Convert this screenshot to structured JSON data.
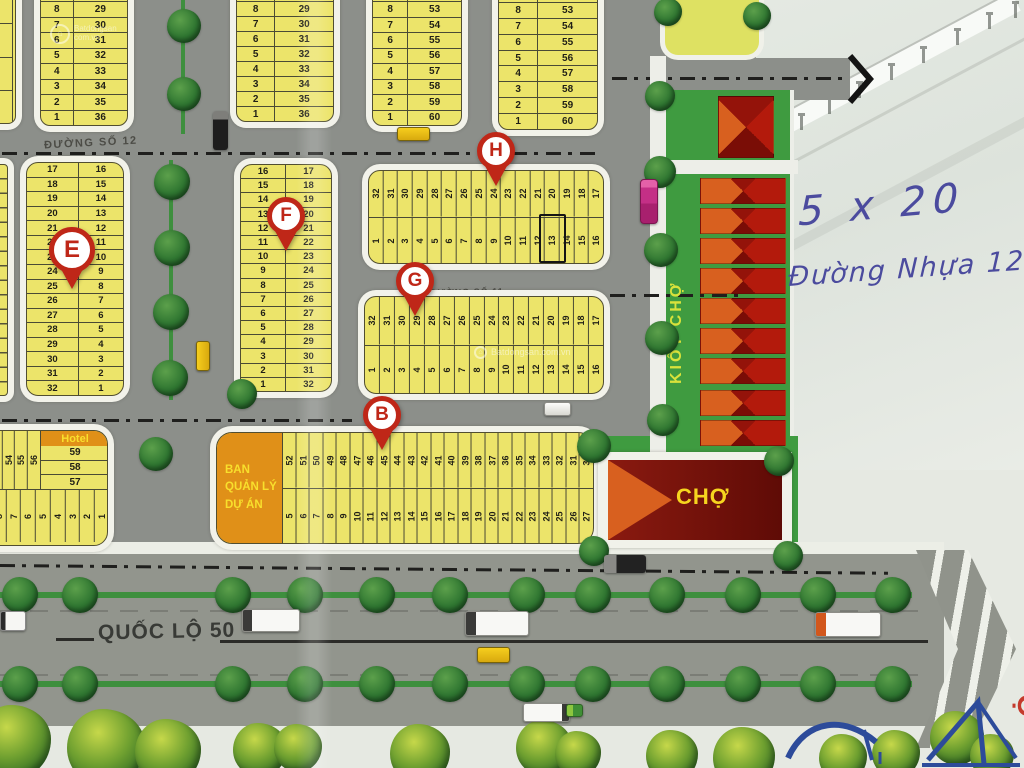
{
  "roads": {
    "street12": "ĐƯỜNG SỐ 12",
    "street11": "ĐƯỜNG SỐ 11",
    "highway": "QUỐC LỘ 50"
  },
  "notes": {
    "size": "5 x 20",
    "road": "Đường Nhựa 12 m."
  },
  "market": {
    "kiosk_label": "KIỐT CHỢ",
    "market_label": "CHỢ"
  },
  "office": {
    "line1": "BAN",
    "line2": "QUẢN LÝ",
    "line3": "DỰ ÁN"
  },
  "hotel": {
    "label": "Hotel",
    "stack": [
      "59",
      "58",
      "57"
    ],
    "top_row": [
      "52",
      "53",
      "54",
      "55",
      "56"
    ],
    "bottom_row": [
      "9",
      "8",
      "7",
      "6",
      "5",
      "4",
      "3",
      "2",
      "1"
    ]
  },
  "pins": {
    "e": "E",
    "f": "F",
    "g": "G",
    "h": "H",
    "b": "B"
  },
  "edge_text": "Ộ",
  "watermark": {
    "site1": "Batdongsan",
    "site2": "com.vn",
    "center": "Batdongsan.com.vn"
  },
  "blocks": {
    "top_partial": [
      "9",
      "8",
      "7",
      "6"
    ],
    "top1": {
      "c1": [
        "9",
        "8",
        "7",
        "6",
        "5",
        "4",
        "3",
        "2",
        "1"
      ],
      "c2": [
        "28",
        "29",
        "30",
        "31",
        "32",
        "33",
        "34",
        "35",
        "36"
      ]
    },
    "top2": {
      "c1": [
        "9",
        "8",
        "7",
        "6",
        "5",
        "4",
        "3",
        "2",
        "1"
      ],
      "c2": [
        "28",
        "29",
        "30",
        "31",
        "32",
        "33",
        "34",
        "35",
        "36"
      ]
    },
    "top3": {
      "c1": [
        "9",
        "8",
        "7",
        "6",
        "5",
        "4",
        "3",
        "2",
        "1"
      ],
      "c2": [
        "52",
        "53",
        "54",
        "55",
        "56",
        "57",
        "58",
        "59",
        "60"
      ]
    },
    "top4": {
      "c1": [
        "9",
        "8",
        "7",
        "6",
        "5",
        "4",
        "3",
        "2",
        "1"
      ],
      "c2": [
        "52",
        "53",
        "54",
        "55",
        "56",
        "57",
        "58",
        "59",
        "60"
      ]
    },
    "e": {
      "c1": [
        "17",
        "18",
        "19",
        "20",
        "21",
        "22",
        "23",
        "24",
        "25",
        "26",
        "27",
        "28",
        "29",
        "30",
        "31",
        "32"
      ],
      "c2": [
        "16",
        "15",
        "14",
        "13",
        "12",
        "11",
        "10",
        "9",
        "8",
        "7",
        "6",
        "5",
        "4",
        "3",
        "2",
        "1"
      ]
    },
    "f": {
      "c1": [
        "16",
        "15",
        "14",
        "13",
        "12",
        "11",
        "10",
        "9",
        "8",
        "7",
        "6",
        "5",
        "4",
        "3",
        "2",
        "1"
      ],
      "c2": [
        "17",
        "18",
        "19",
        "20",
        "21",
        "22",
        "23",
        "24",
        "25",
        "26",
        "27",
        "28",
        "29",
        "30",
        "31",
        "32"
      ]
    },
    "h": {
      "r1": [
        "32",
        "31",
        "30",
        "29",
        "28",
        "27",
        "26",
        "25",
        "24",
        "23",
        "22",
        "21",
        "20",
        "19",
        "18",
        "17"
      ],
      "r2": [
        "1",
        "2",
        "3",
        "4",
        "5",
        "6",
        "7",
        "8",
        "9",
        "10",
        "11",
        "12",
        "13",
        "14",
        "15",
        "16"
      ]
    },
    "g": {
      "r1": [
        "32",
        "31",
        "30",
        "29",
        "28",
        "27",
        "26",
        "25",
        "24",
        "23",
        "22",
        "21",
        "20",
        "19",
        "18",
        "17"
      ],
      "r2": [
        "1",
        "2",
        "3",
        "4",
        "5",
        "6",
        "7",
        "8",
        "9",
        "10",
        "11",
        "12",
        "13",
        "14",
        "15",
        "16"
      ]
    },
    "b": {
      "r1": [
        "52",
        "51",
        "50",
        "49",
        "48",
        "47",
        "46",
        "45",
        "44",
        "43",
        "42",
        "41",
        "40",
        "39",
        "38",
        "37",
        "36",
        "35",
        "34",
        "33",
        "32",
        "31",
        "30"
      ],
      "r2": [
        "5",
        "6",
        "7",
        "8",
        "9",
        "10",
        "11",
        "12",
        "13",
        "14",
        "15",
        "16",
        "17",
        "18",
        "19",
        "20",
        "21",
        "22",
        "23",
        "24",
        "25",
        "26",
        "27"
      ]
    }
  },
  "colors": {
    "lot_yellow": "#ece46a",
    "road_gray": "#8c8f8a",
    "market_green": "#3f9b40",
    "stall_red": "#a01508",
    "stall_orange": "#d8601f",
    "market_maroon": "#701008",
    "accent_orange": "#e09018",
    "pin_red": "#bf2718",
    "ink_blue": "#4b4b9e",
    "text_yellow": "#f6d51f"
  },
  "icons": {
    "tree-icon": "green blob circle",
    "bush-icon": "light green blob",
    "market-stall-icon": "red conic X rectangle",
    "map-pin-icon": "red circle marker with tail",
    "car-icon": "rounded rect",
    "truck-icon": "two-tone rect",
    "chevron-arrow-icon": "black angle stroke",
    "highway-arrow-icon": "striped chevron polygon",
    "lamp-post-icon": "small gray post"
  }
}
